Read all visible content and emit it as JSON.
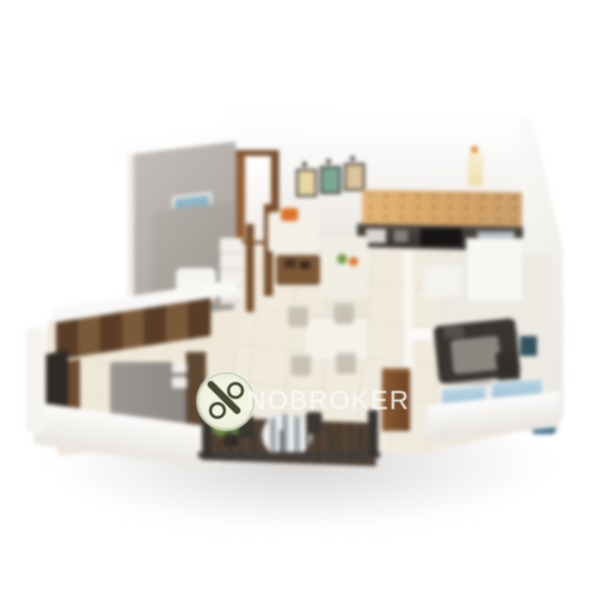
{
  "image": {
    "kind": "3d-isometric-floorplan-photo",
    "description": "Blurred 3D rendered floor plan of a 2 BHK apartment viewed from above on a plain white background",
    "background_color": "#ffffff"
  },
  "watermark": {
    "text": "NOBROKER",
    "logo_icon": "crossed-percent-icon",
    "text_color": "rgba(250,250,248,0.82)",
    "logo_fill": "#f0f2e2",
    "logo_glyph_color": "#474b33"
  },
  "scene": {
    "rooms": [
      {
        "name": "bathroom-top-left",
        "features": "grey tiled walls with small blue window"
      },
      {
        "name": "entrance",
        "features": "open wooden door on the back wall"
      },
      {
        "name": "living-room",
        "features": "cream sofa with orange cushion, wooden coffee table, three art frames on wall"
      },
      {
        "name": "dining-area",
        "features": "four-seater dining table with beige chairs"
      },
      {
        "name": "kitchen",
        "features": "dark granite counter with hob, sink and oven, beige mottled backsplash"
      },
      {
        "name": "bedroom-left",
        "features": "grey bed with wooden headboard, segmented brown wardrobe, TV unit"
      },
      {
        "name": "bedroom-right",
        "features": "dark bed with grey blanket, blue windows, blue chair"
      },
      {
        "name": "bathroom-centre",
        "features": "grey tiled internal bathroom with white fixtures and shelf"
      },
      {
        "name": "balcony",
        "features": "dark wood deck, striped bistro table with two chairs, green plant, dark railing"
      },
      {
        "name": "passage-right",
        "features": "white cabinets and console along hallway"
      }
    ]
  },
  "palette": {
    "wall_white": "#f5f3f0",
    "bath_grey": "#aaa49e",
    "floor_cream": "#f1ebdf",
    "door_wood": "#7a4f2c",
    "kitchen_counter": "#2e2a27",
    "backsplash_beige": "#d5a468",
    "accent_orange": "#de7327",
    "window_blue": "#8fb9cb",
    "deck_wood": "#4e3e31",
    "bed_grey": "#8a8681",
    "bed_dark": "#3a3531"
  }
}
